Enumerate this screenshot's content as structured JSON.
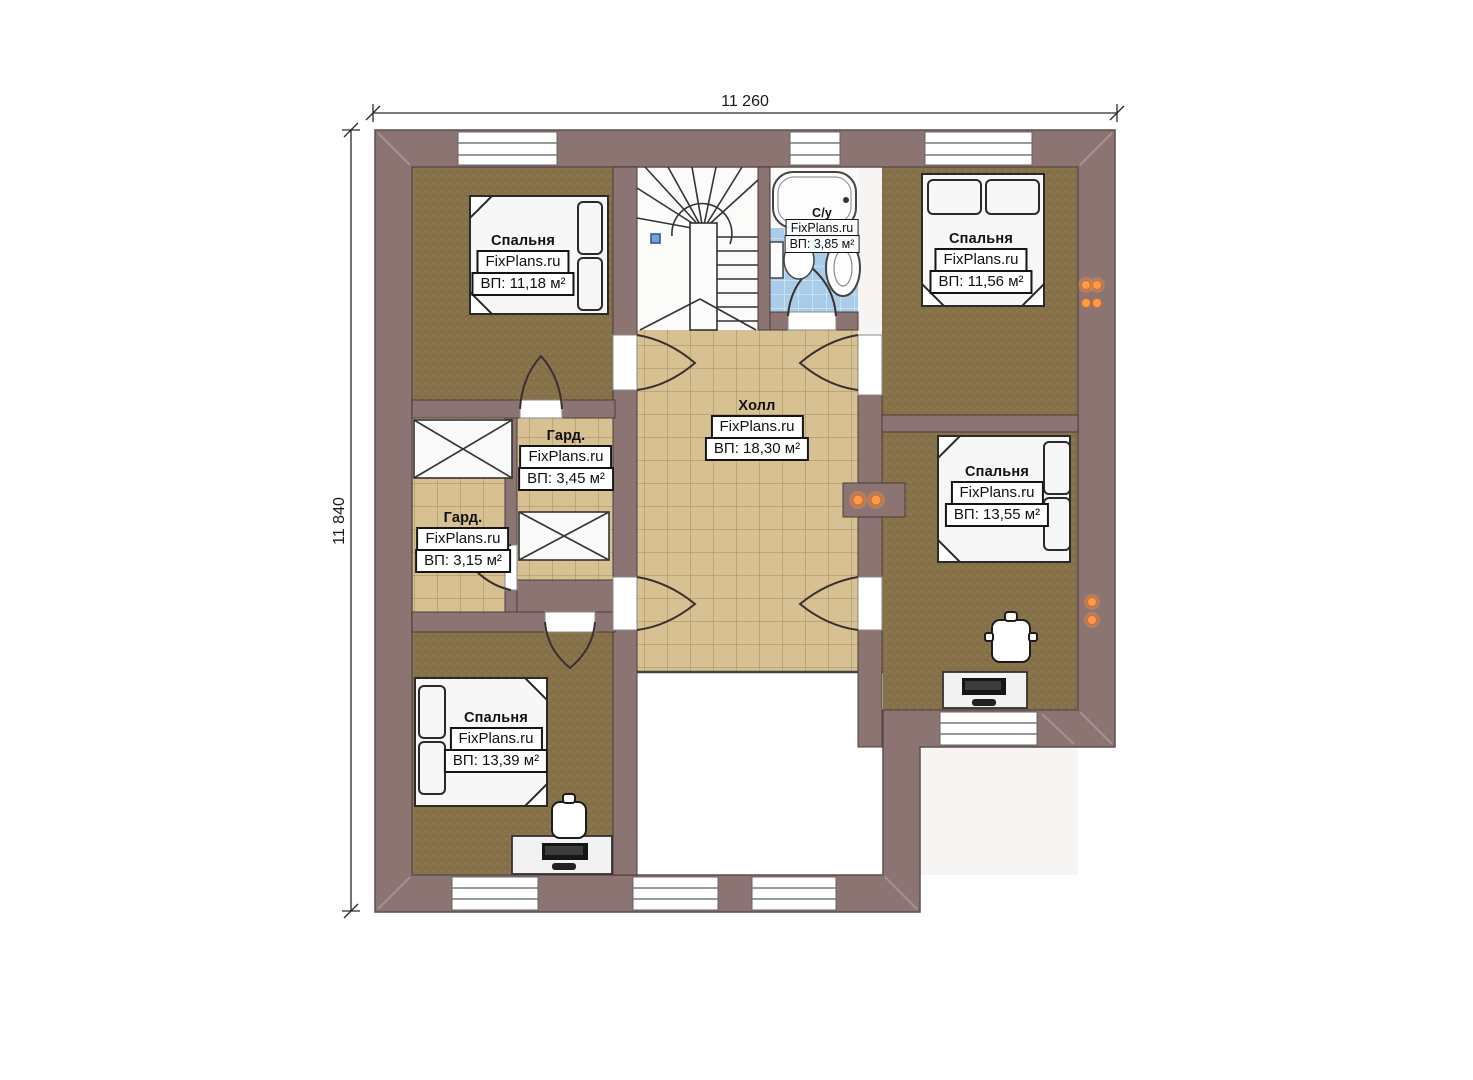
{
  "plan": {
    "type": "floor-plan",
    "dimensions": {
      "top": "11 260",
      "left": "11 840"
    },
    "rooms": [
      {
        "name": "Спальня",
        "watermark": "FixPlans.ru",
        "area": "ВП: 11,18 м²"
      },
      {
        "name": "С/у",
        "watermark": "FixPlans.ru",
        "area": "ВП: 3,85 м²"
      },
      {
        "name": "Спальня",
        "watermark": "FixPlans.ru",
        "area": "ВП: 11,56 м²"
      },
      {
        "name": "Гард.",
        "watermark": "FixPlans.ru",
        "area": "ВП: 3,45 м²"
      },
      {
        "name": "Гард.",
        "watermark": "FixPlans.ru",
        "area": "ВП: 3,15 м²"
      },
      {
        "name": "Холл",
        "watermark": "FixPlans.ru",
        "area": "ВП: 18,30 м²"
      },
      {
        "name": "Спальня",
        "watermark": "FixPlans.ru",
        "area": "ВП: 13,55 м²"
      },
      {
        "name": "Спальня",
        "watermark": "FixPlans.ru",
        "area": "ВП: 13,39 м²"
      }
    ],
    "colors": {
      "wall": "#8c7473",
      "bedroom_floor": "#877149",
      "tile_floor": "#d7c193",
      "tile_line": "#a18a58",
      "bath_tile": "#a9cde9",
      "bath_line": "#e3f1fa",
      "outlet": "#ff9a4d",
      "stair_marker": "#7aa0d4"
    }
  }
}
